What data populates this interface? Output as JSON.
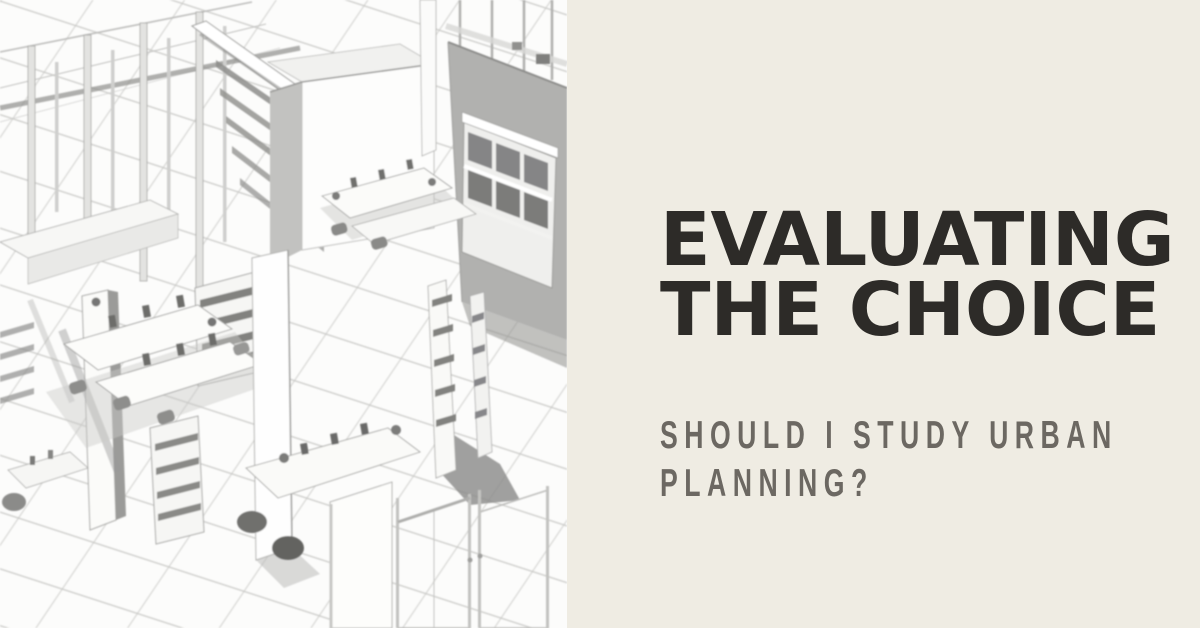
{
  "banner": {
    "title": {
      "line1": "EVALUATING",
      "line2": "THE CHOICE"
    },
    "subtitle": {
      "line1": "SHOULD I STUDY URBAN",
      "line2": "PLANNING?"
    },
    "colors": {
      "panel_background": "#efece3",
      "title_text": "#2d2b28",
      "subtitle_text": "#6c6862",
      "illustration_background": "#fcfcfb",
      "illustration_line_gray": "#c6c6c3",
      "illustration_shadow_gray": "#8e8e8c"
    },
    "illustration": {
      "name": "isometric-office-wireframe",
      "alt": "Monochrome 3D wireframe rendering of an open-plan office interior with desks, monitors, chairs, bookshelves, columns, glass partitions and a tiled floor grid"
    }
  }
}
